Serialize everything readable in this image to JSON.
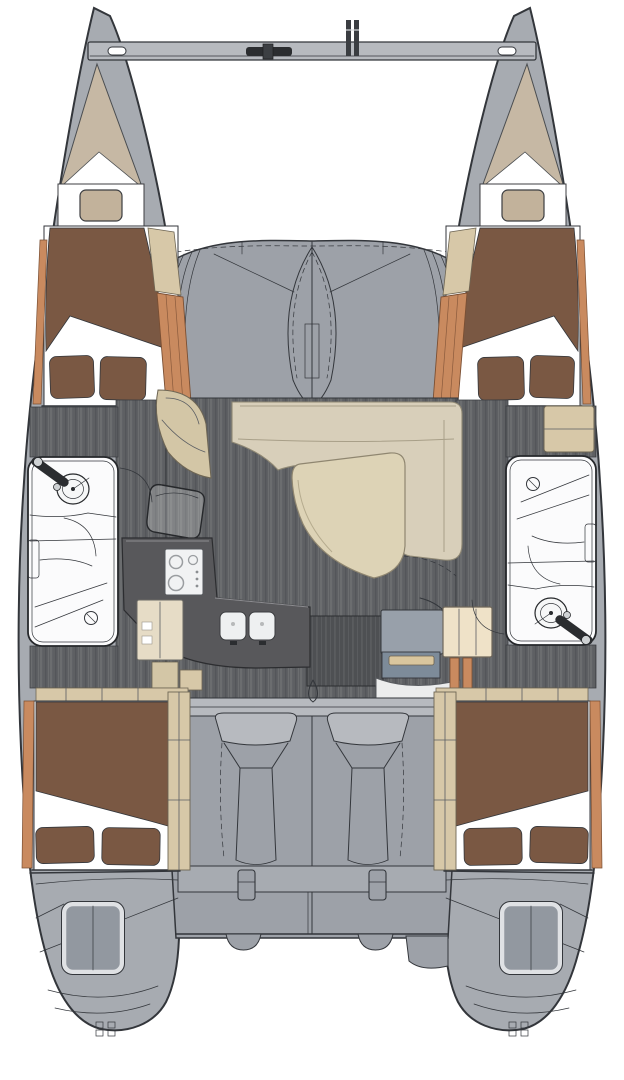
{
  "diagram": {
    "type": "catamaran-interior-layout-plan",
    "view": "top-down-deck-plan",
    "text_content": "none — drawing contains no visible text"
  },
  "colors": {
    "background": "#ffffff",
    "outline": "#33363b",
    "deck_gray": "#a7abb1",
    "deck_mid": "#9da1a8",
    "deck_light": "#b7babf",
    "forepeak_tan": "#c6b8a4",
    "pillow_tan": "#c2b29b",
    "bed_brown": "#7a5843",
    "linen_white": "#ffffff",
    "wood_orange": "#c98a5f",
    "wood_light": "#d7c8a8",
    "steps_cream": "#d3c6a6",
    "floor_dark": "#5e6063",
    "floor_streak": "#6b6d6f",
    "floor_shadow": "#54565a",
    "companionway_floor": "#4e5053",
    "companionway_streak": "#5a5c5f",
    "settee_cream": "#d8cfba",
    "table_wood": "#ddd3b6",
    "galley_counter": "#58585b",
    "appliance_white": "#f1f2f3",
    "sink_white": "#eef0f1",
    "cabinet_beige": "#e6dcc6",
    "head_white": "#fbfbfc",
    "fixture_white": "#f6f7f7",
    "nav_gray": "#98a0aa",
    "nav_front_blue": "#7d8b99",
    "nav_cream": "#efe2c8",
    "slat_tan": "#d9c69e",
    "bench_white": "#eceded",
    "hatch_gray": "#9298a0",
    "dark_fitting": "#2b2d30",
    "knob_gray": "#cfd2d4"
  },
  "parts": [
    "port-hull",
    "starboard-hull",
    "bridgedeck",
    "forward-crossbeam",
    "windlass",
    "seagull-striker",
    "trampoline-area",
    "port-forepeak",
    "starboard-forepeak",
    "port-forward-berth",
    "starboard-forward-berth",
    "port-head",
    "starboard-head",
    "salon-settee",
    "salon-table",
    "salon-chair",
    "galley-counter",
    "stove",
    "double-sink",
    "galley-cabinet",
    "companionway-steps",
    "nav-station",
    "cockpit",
    "cockpit-seats",
    "aft-bench",
    "port-aft-berth",
    "starboard-aft-berth",
    "port-transom-hatch",
    "starboard-transom-hatch",
    "swim-steps",
    "stern-cleats"
  ]
}
